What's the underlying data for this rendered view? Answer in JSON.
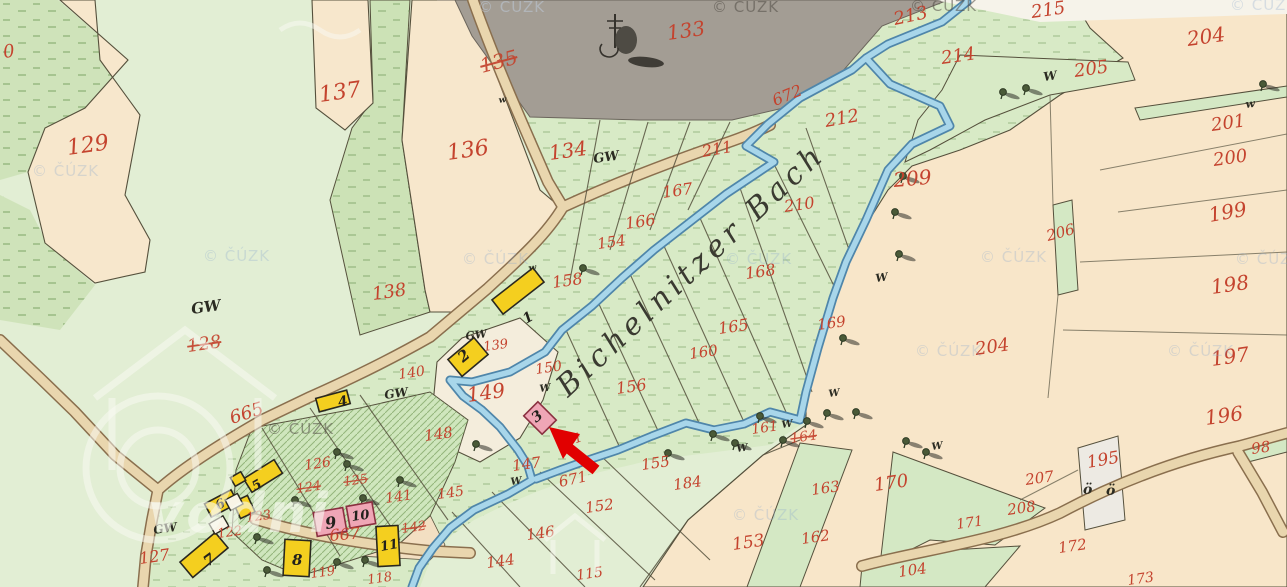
{
  "map": {
    "stream_label": {
      "text": "Bichelnitzer Bach"
    },
    "watermark": {
      "text": "© ČÚZK"
    },
    "watermark_large": {
      "text": "vodni"
    },
    "annotation_arrow": {
      "shape": "arrow",
      "color": "#e10000",
      "points_to": "building-3"
    },
    "colors": {
      "parcel_number_red": "#c4432e",
      "house_number_black": "#23211c",
      "house_number_red": "#7d2718",
      "building_yellow": "#f4cf1f",
      "building_pink": "#efa6b6",
      "stream_blue": "#a8d6ea",
      "stream_edge": "#4f86aa",
      "road_tan": "#e9d6ae",
      "dark_area": "#a39d94",
      "meadow_green": "#d8eac6",
      "field_cream": "#f7e7cc",
      "arrow_red": "#e10000"
    },
    "parcel_labels": [
      {
        "t": "0",
        "x": 4,
        "y": 58,
        "s": 18
      },
      {
        "t": "129",
        "x": 68,
        "y": 155,
        "s": 22
      },
      {
        "t": "137",
        "x": 320,
        "y": 102,
        "s": 22
      },
      {
        "t": "135",
        "x": 482,
        "y": 73,
        "s": 20,
        "r": -15,
        "k": true
      },
      {
        "t": "136",
        "x": 448,
        "y": 160,
        "s": 22
      },
      {
        "t": "134",
        "x": 550,
        "y": 160,
        "s": 20
      },
      {
        "t": "133",
        "x": 668,
        "y": 40,
        "s": 20
      },
      {
        "t": "213",
        "x": 895,
        "y": 25,
        "s": 18,
        "r": -12
      },
      {
        "t": "215",
        "x": 1032,
        "y": 18,
        "s": 18
      },
      {
        "t": "214",
        "x": 942,
        "y": 64,
        "s": 18
      },
      {
        "t": "204",
        "x": 1188,
        "y": 46,
        "s": 20
      },
      {
        "t": "205",
        "x": 1075,
        "y": 77,
        "s": 18
      },
      {
        "t": "212",
        "x": 826,
        "y": 127,
        "s": 18,
        "r": -10
      },
      {
        "t": "672",
        "x": 775,
        "y": 106,
        "s": 16,
        "r": -22
      },
      {
        "t": "211",
        "x": 703,
        "y": 157,
        "s": 16,
        "r": -10
      },
      {
        "t": "201",
        "x": 1212,
        "y": 131,
        "s": 18
      },
      {
        "t": "200",
        "x": 1214,
        "y": 166,
        "s": 18
      },
      {
        "t": "209",
        "x": 894,
        "y": 187,
        "s": 20,
        "r": -5
      },
      {
        "t": "210",
        "x": 785,
        "y": 212,
        "s": 16
      },
      {
        "t": "199",
        "x": 1210,
        "y": 222,
        "s": 20,
        "r": -10
      },
      {
        "t": "167",
        "x": 663,
        "y": 198,
        "s": 16
      },
      {
        "t": "166",
        "x": 626,
        "y": 229,
        "s": 16
      },
      {
        "t": "154",
        "x": 598,
        "y": 249,
        "s": 15
      },
      {
        "t": "158",
        "x": 553,
        "y": 288,
        "s": 16
      },
      {
        "t": "168",
        "x": 746,
        "y": 279,
        "s": 16
      },
      {
        "t": "206",
        "x": 1048,
        "y": 241,
        "s": 15,
        "r": -15
      },
      {
        "t": "198",
        "x": 1212,
        "y": 294,
        "s": 20,
        "r": -8
      },
      {
        "t": "165",
        "x": 719,
        "y": 334,
        "s": 16
      },
      {
        "t": "169",
        "x": 818,
        "y": 330,
        "s": 15
      },
      {
        "t": "160",
        "x": 690,
        "y": 359,
        "s": 15
      },
      {
        "t": "128",
        "x": 188,
        "y": 352,
        "s": 18,
        "k": true
      },
      {
        "t": "138",
        "x": 373,
        "y": 300,
        "s": 18
      },
      {
        "t": "204",
        "x": 976,
        "y": 355,
        "s": 18
      },
      {
        "t": "197",
        "x": 1212,
        "y": 366,
        "s": 20,
        "r": -8
      },
      {
        "t": "139",
        "x": 484,
        "y": 351,
        "s": 13
      },
      {
        "t": "140",
        "x": 399,
        "y": 379,
        "s": 14
      },
      {
        "t": "150",
        "x": 536,
        "y": 374,
        "s": 14
      },
      {
        "t": "149",
        "x": 468,
        "y": 402,
        "s": 20
      },
      {
        "t": "156",
        "x": 617,
        "y": 394,
        "s": 16
      },
      {
        "t": "196",
        "x": 1206,
        "y": 425,
        "s": 20,
        "r": -8
      },
      {
        "t": "148",
        "x": 425,
        "y": 441,
        "s": 15
      },
      {
        "t": "147",
        "x": 513,
        "y": 471,
        "s": 15
      },
      {
        "t": "151",
        "x": 560,
        "y": 449,
        "s": 13,
        "r": -20
      },
      {
        "t": "671",
        "x": 560,
        "y": 487,
        "s": 15,
        "r": -12
      },
      {
        "t": "155",
        "x": 642,
        "y": 470,
        "s": 15
      },
      {
        "t": "161",
        "x": 752,
        "y": 434,
        "s": 14
      },
      {
        "t": "164",
        "x": 791,
        "y": 443,
        "s": 14,
        "k": true
      },
      {
        "t": "184",
        "x": 674,
        "y": 490,
        "s": 15
      },
      {
        "t": "195",
        "x": 1088,
        "y": 468,
        "s": 17,
        "r": -10
      },
      {
        "t": "98",
        "x": 1252,
        "y": 454,
        "s": 15
      },
      {
        "t": "207",
        "x": 1026,
        "y": 485,
        "s": 15
      },
      {
        "t": "208",
        "x": 1008,
        "y": 515,
        "s": 15
      },
      {
        "t": "170",
        "x": 875,
        "y": 491,
        "s": 18
      },
      {
        "t": "665",
        "x": 232,
        "y": 424,
        "s": 18,
        "r": -18
      },
      {
        "t": "126",
        "x": 305,
        "y": 470,
        "s": 14
      },
      {
        "t": "125",
        "x": 344,
        "y": 486,
        "s": 13,
        "k": true
      },
      {
        "t": "124",
        "x": 297,
        "y": 493,
        "s": 13,
        "k": true
      },
      {
        "t": "141",
        "x": 386,
        "y": 503,
        "s": 14
      },
      {
        "t": "123",
        "x": 247,
        "y": 522,
        "s": 13
      },
      {
        "t": "122",
        "x": 218,
        "y": 538,
        "s": 13
      },
      {
        "t": "667",
        "x": 330,
        "y": 541,
        "s": 16,
        "r": -5
      },
      {
        "t": "145",
        "x": 438,
        "y": 499,
        "s": 14
      },
      {
        "t": "142",
        "x": 402,
        "y": 533,
        "s": 13,
        "k": true
      },
      {
        "t": "152",
        "x": 586,
        "y": 513,
        "s": 15
      },
      {
        "t": "146",
        "x": 527,
        "y": 540,
        "s": 15
      },
      {
        "t": "127",
        "x": 140,
        "y": 564,
        "s": 16
      },
      {
        "t": "144",
        "x": 487,
        "y": 568,
        "s": 15
      },
      {
        "t": "119",
        "x": 311,
        "y": 578,
        "s": 13
      },
      {
        "t": "118",
        "x": 368,
        "y": 584,
        "s": 13
      },
      {
        "t": "115",
        "x": 577,
        "y": 580,
        "s": 14
      },
      {
        "t": "153",
        "x": 733,
        "y": 550,
        "s": 17
      },
      {
        "t": "162",
        "x": 802,
        "y": 544,
        "s": 15
      },
      {
        "t": "163",
        "x": 812,
        "y": 495,
        "s": 15
      },
      {
        "t": "171",
        "x": 957,
        "y": 529,
        "s": 14
      },
      {
        "t": "172",
        "x": 1059,
        "y": 553,
        "s": 15
      },
      {
        "t": "104",
        "x": 899,
        "y": 577,
        "s": 15
      },
      {
        "t": "173",
        "x": 1128,
        "y": 585,
        "s": 14
      }
    ],
    "ground_labels": [
      {
        "t": "GW",
        "x": 192,
        "y": 314,
        "s": 15
      },
      {
        "t": "GW",
        "x": 594,
        "y": 163,
        "s": 13
      },
      {
        "t": "GW",
        "x": 466,
        "y": 340,
        "s": 11
      },
      {
        "t": "GW",
        "x": 385,
        "y": 399,
        "s": 12
      },
      {
        "t": "GW",
        "x": 154,
        "y": 534,
        "s": 12
      },
      {
        "t": "W",
        "x": 1044,
        "y": 81,
        "s": 12
      },
      {
        "t": "w",
        "x": 1246,
        "y": 108,
        "s": 11
      },
      {
        "t": "W",
        "x": 876,
        "y": 282,
        "s": 11
      },
      {
        "t": "W",
        "x": 829,
        "y": 397,
        "s": 10
      },
      {
        "t": "W",
        "x": 782,
        "y": 428,
        "s": 10
      },
      {
        "t": "W",
        "x": 737,
        "y": 452,
        "s": 10
      },
      {
        "t": "W",
        "x": 932,
        "y": 450,
        "s": 10
      },
      {
        "t": "W",
        "x": 540,
        "y": 392,
        "s": 10
      },
      {
        "t": "W",
        "x": 511,
        "y": 485,
        "s": 10
      },
      {
        "t": "w",
        "x": 529,
        "y": 271,
        "s": 9
      },
      {
        "t": "w",
        "x": 499,
        "y": 103,
        "s": 9
      },
      {
        "t": "ö",
        "x": 1083,
        "y": 494,
        "s": 14,
        "r": 0
      },
      {
        "t": "ö",
        "x": 1106,
        "y": 495,
        "s": 14,
        "r": 0
      }
    ],
    "house_numbers": [
      {
        "t": "1",
        "x": 526,
        "y": 324,
        "r": -30,
        "s": 14
      },
      {
        "t": "2",
        "x": 463,
        "y": 363,
        "r": -40,
        "s": 15
      },
      {
        "t": "3",
        "x": 536,
        "y": 423,
        "r": -38,
        "s": 14
      },
      {
        "t": "4",
        "x": 339,
        "y": 407,
        "r": -12,
        "s": 14
      },
      {
        "t": "5",
        "x": 255,
        "y": 491,
        "r": -30,
        "s": 13
      },
      {
        "t": "6",
        "x": 218,
        "y": 510,
        "r": -26,
        "s": 13
      },
      {
        "t": "7",
        "x": 208,
        "y": 567,
        "r": -36,
        "s": 15
      },
      {
        "t": "8",
        "x": 292,
        "y": 565,
        "r": 0,
        "s": 15
      },
      {
        "t": "9",
        "x": 326,
        "y": 529,
        "r": -8,
        "s": 16,
        "c": "#7d2718"
      },
      {
        "t": "10",
        "x": 352,
        "y": 521,
        "r": -8,
        "s": 13,
        "c": "#7d2718"
      },
      {
        "t": "11",
        "x": 381,
        "y": 551,
        "r": -10,
        "s": 13
      }
    ],
    "watermarks": [
      {
        "x": 478,
        "y": 12,
        "v": "light"
      },
      {
        "x": 712,
        "y": 12,
        "v": "dark"
      },
      {
        "x": 910,
        "y": 11,
        "v": "dark"
      },
      {
        "x": 1230,
        "y": 10,
        "v": "faint"
      },
      {
        "x": 32,
        "y": 176,
        "v": "faint"
      },
      {
        "x": 203,
        "y": 261,
        "v": "faint"
      },
      {
        "x": 462,
        "y": 264,
        "v": "faint"
      },
      {
        "x": 725,
        "y": 264,
        "v": "faint"
      },
      {
        "x": 980,
        "y": 262,
        "v": "faint"
      },
      {
        "x": 1235,
        "y": 264,
        "v": "faint"
      },
      {
        "x": 915,
        "y": 356,
        "v": "faint"
      },
      {
        "x": 1167,
        "y": 356,
        "v": "faint"
      },
      {
        "x": 267,
        "y": 434,
        "v": "dark"
      },
      {
        "x": 732,
        "y": 520,
        "v": "faint"
      }
    ]
  }
}
